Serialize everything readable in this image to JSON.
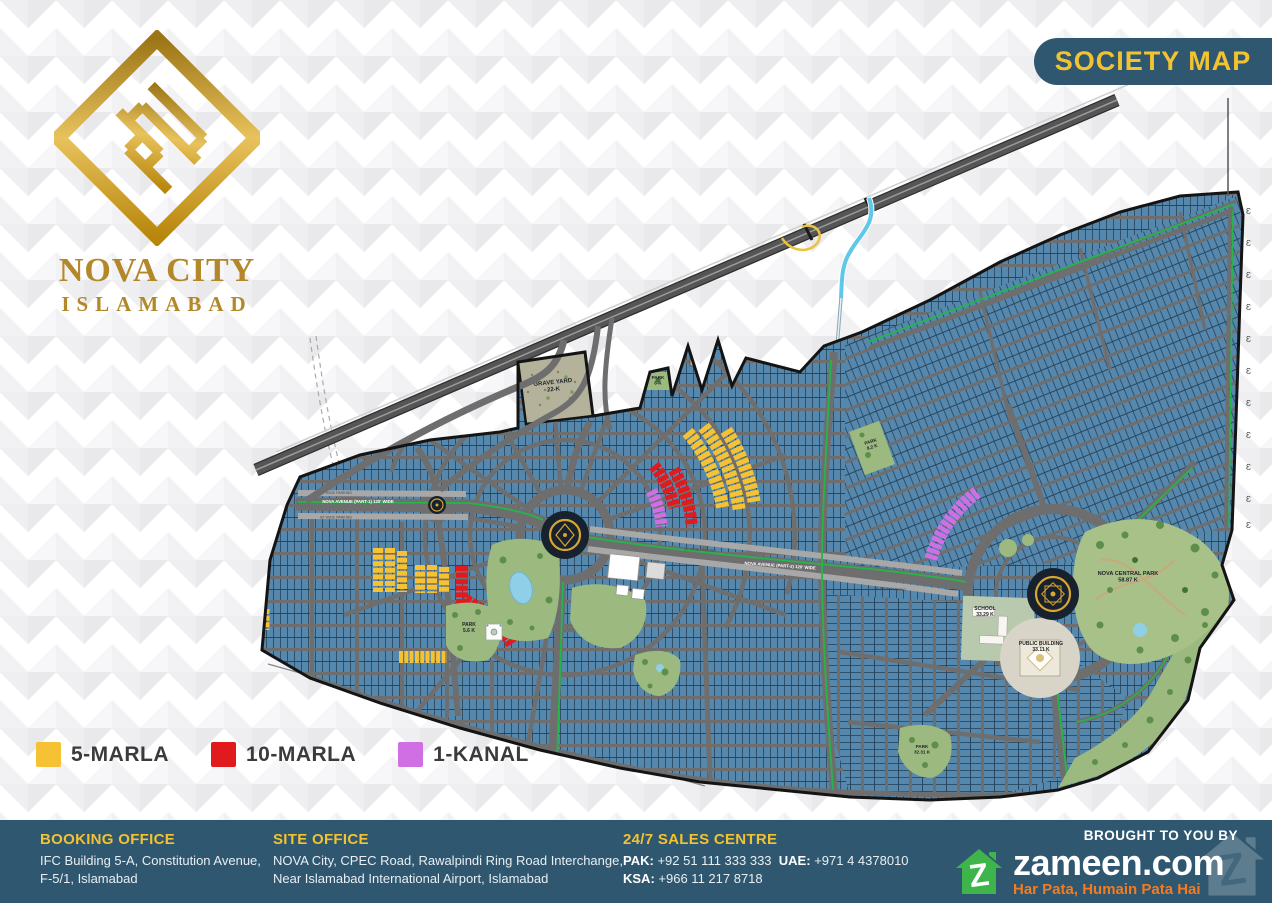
{
  "colors": {
    "teal": "#2f5870",
    "gold": "#f2c230",
    "logo_gold": "#b3882a",
    "legend_text": "#3b3b3b",
    "zameen_green": "#3db54a",
    "zameen_orange": "#f47b20",
    "white": "#ffffff"
  },
  "header": {
    "banner": "SOCIETY MAP"
  },
  "logo": {
    "title": "NOVA CITY",
    "subtitle": "ISLAMABAD"
  },
  "legend": {
    "items": [
      {
        "label": "5-MARLA",
        "color": "#f6c233"
      },
      {
        "label": "10-MARLA",
        "color": "#e11a1d"
      },
      {
        "label": "1-KANAL",
        "color": "#d06fe3"
      }
    ]
  },
  "footer": {
    "booking_office": {
      "title": "BOOKING OFFICE",
      "line1": "IFC Building 5-A, Constitution Avenue,",
      "line2": "F-5/1, Islamabad"
    },
    "site_office": {
      "title": "SITE OFFICE",
      "line1": "NOVA City, CPEC Road, Rawalpindi Ring Road Interchange,",
      "line2": "Near Islamabad International Airport, Islamabad"
    },
    "sales_centre": {
      "title": "24/7 SALES CENTRE",
      "numbers": [
        {
          "label": "PAK:",
          "value": "+92 51 111 333 333"
        },
        {
          "label": "UAE:",
          "value": "+971 4 4378010"
        },
        {
          "label": "KSA:",
          "value": "+966 11 217 8718"
        }
      ]
    },
    "brought_by": "BROUGHT TO YOU BY",
    "zameen": {
      "name": "zameen.com",
      "tagline": "Har Pata, Humain Pata Hai"
    }
  },
  "map": {
    "colors": {
      "plot_fill": "#5688ad",
      "plot_line": "#27465f",
      "street": "#6e6e6e",
      "road": "#6e6e6e",
      "parking": "#a8a8a8",
      "median_green": "#25b54b",
      "park": "#9cb97f",
      "park_dark": "#5d8f4a",
      "tree_dark": "#3f7336",
      "boundary": "#141414",
      "highway": "#555555",
      "highway_edge": "#2e2e2e",
      "stream": "#5fc8e8",
      "marla5": "#f6c233",
      "marla10": "#e11a1d",
      "kanal1": "#d06fe3",
      "graveyard": "#b5b29b",
      "water": "#8fd0e8",
      "island": "#17222e",
      "ornament_gold": "#d9a62f",
      "label": "#20252a"
    },
    "labels": [
      {
        "lines": [
          "GRAVE YARD",
          "22-K"
        ],
        "x": 553,
        "y": 384,
        "size": 6,
        "bold": true,
        "rot": -6
      },
      {
        "lines": [
          "PARK",
          "8-K"
        ],
        "x": 658,
        "y": 379,
        "size": 4.6,
        "bold": true
      },
      {
        "lines": [
          "PARK",
          "8.2 K"
        ],
        "x": 871,
        "y": 443,
        "size": 4.6,
        "bold": true,
        "rot": -18
      },
      {
        "lines": [
          "PARK",
          "5.6 K"
        ],
        "x": 469,
        "y": 626,
        "size": 5,
        "bold": true
      },
      {
        "lines": [
          "NOVA CENTRAL PARK",
          "58.87 K"
        ],
        "x": 1128,
        "y": 575,
        "size": 5.6,
        "bold": true
      },
      {
        "lines": [
          "SCHOOL",
          "33.29 K"
        ],
        "x": 985,
        "y": 610,
        "size": 5,
        "bold": true
      },
      {
        "lines": [
          "PUBLIC BUILDING",
          "33.11 K"
        ],
        "x": 1041,
        "y": 645,
        "size": 5,
        "bold": true
      },
      {
        "lines": [
          "PARK",
          "32.31 K"
        ],
        "x": 922,
        "y": 748,
        "size": 4.6,
        "bold": true
      },
      {
        "lines": [
          "NOVA AVENUE (PART-1) 120' WIDE"
        ],
        "x": 358,
        "y": 503,
        "size": 4.3,
        "bold": true,
        "color": "#ffffff"
      },
      {
        "lines": [
          "NOVA AVENUE (PART-2) 120' WIDE"
        ],
        "x": 780,
        "y": 567,
        "size": 4.3,
        "bold": true,
        "color": "#ffffff",
        "rot": 4
      },
      {
        "lines": [
          "60' WIDE PARKING"
        ],
        "x": 336,
        "y": 494,
        "size": 3.6,
        "color": "#4a4a4a"
      },
      {
        "lines": [
          "60' WIDE PARKING"
        ],
        "x": 336,
        "y": 518.5,
        "size": 3.6,
        "color": "#4a4a4a"
      },
      {
        "lines": [
          "60' WIDE PARKING"
        ],
        "x": 700,
        "y": 551,
        "size": 3.6,
        "color": "#4a4a4a",
        "rot": 4
      },
      {
        "lines": [
          "60' WIDE PARKING"
        ],
        "x": 890,
        "y": 590,
        "size": 3.6,
        "color": "#4a4a4a",
        "rot": 4
      }
    ],
    "pylons": {
      "glyph": "Ɛ",
      "x": 1246,
      "size": 8.5,
      "ys": [
        214,
        246,
        278,
        310,
        342,
        374,
        406,
        438,
        470,
        502,
        528
      ]
    }
  }
}
